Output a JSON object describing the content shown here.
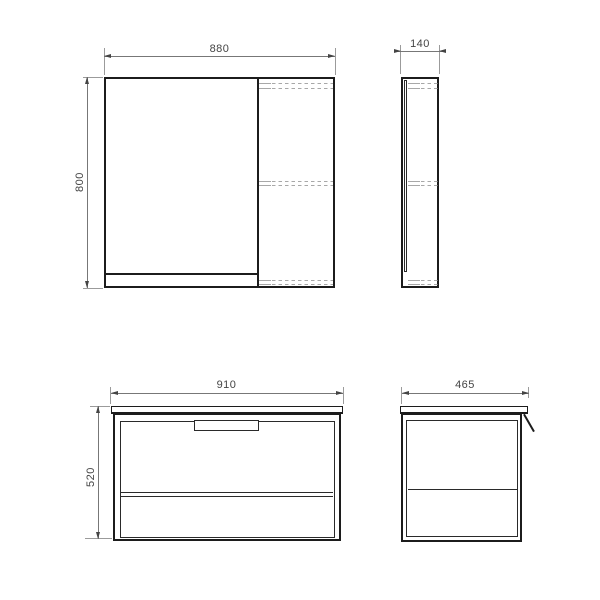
{
  "drawing": {
    "title": "furniture-dimension-drawing",
    "views": {
      "mirror_front": {
        "name": "mirror-cabinet-front-view",
        "width_label": "880",
        "height_label": "800"
      },
      "mirror_side": {
        "name": "mirror-cabinet-side-view",
        "depth_label": "140"
      },
      "vanity_front": {
        "name": "vanity-unit-front-view",
        "width_label": "910",
        "height_label": "520"
      },
      "vanity_side": {
        "name": "vanity-unit-side-view",
        "depth_label": "465"
      }
    },
    "colors": {
      "background": "#ffffff",
      "outline": "#1c1c1c",
      "outline_thin": "#2a2a2a",
      "dimension_line": "#777777",
      "extension_line": "#9b9b9b",
      "hidden_line": "#a8a8a8",
      "arrow": "#444444",
      "text": "#444444"
    }
  }
}
